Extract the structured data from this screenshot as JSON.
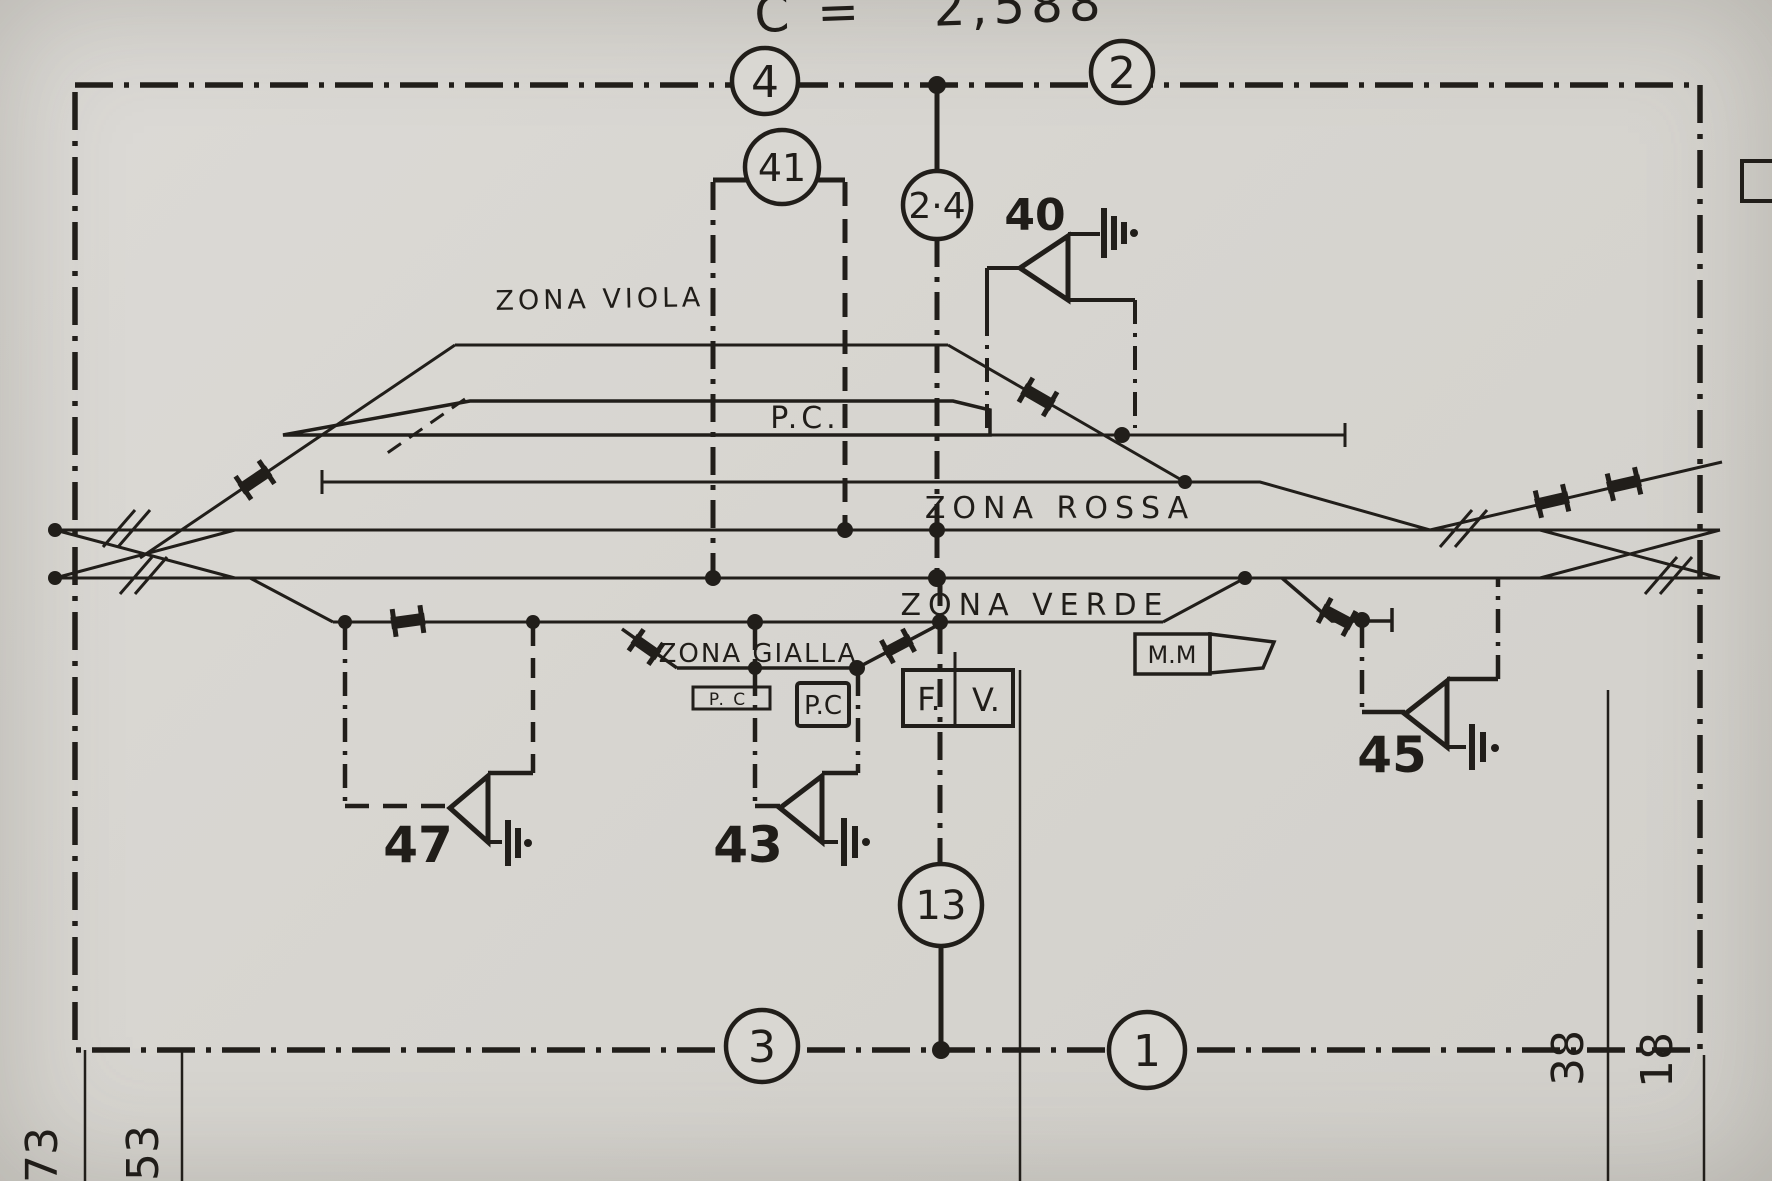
{
  "note_top": "C = ″ 2,588",
  "circle_labels": {
    "top_left": "4",
    "top_right": "2",
    "loop": "41",
    "c24": "2·4",
    "c13": "13",
    "bottom_left": "3",
    "bottom_right": "1"
  },
  "zones": {
    "viola": "ZONA VIOLA",
    "rossa": "ZONA ROSSA",
    "verde": "ZONA VERDE",
    "gialla": "ZONA GIALLA"
  },
  "platform_label": "P.C.",
  "boxes": {
    "pc_flat": "P. C",
    "pc_square": "P.C",
    "fv_left": "F.",
    "fv_right": "V.",
    "mm": "M.M"
  },
  "signals": {
    "s40": "40",
    "s43": "43",
    "s45": "45",
    "s47": "47"
  },
  "margins": {
    "m73": "73",
    "m53": "53",
    "m38": "38",
    "m18": "18"
  },
  "ink_color": "#211e1a"
}
